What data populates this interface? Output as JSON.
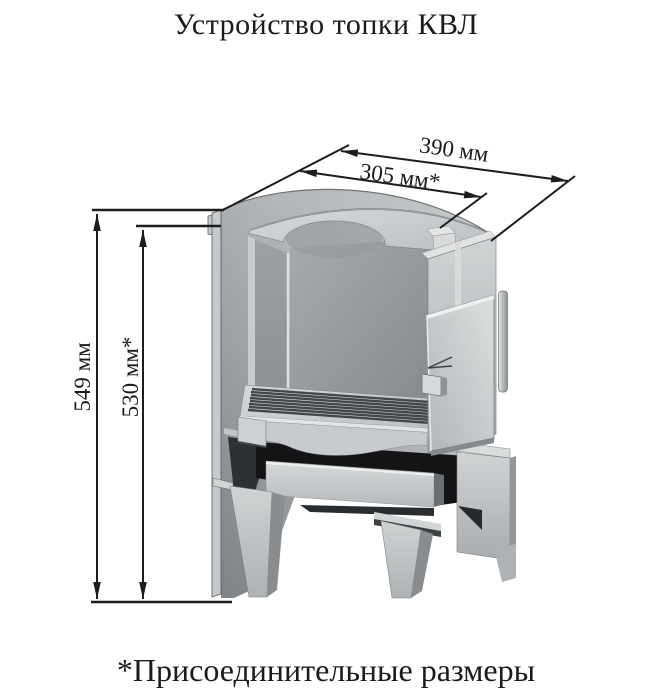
{
  "title": "Устройство топки КВЛ",
  "footnote": "*Присоединительные размеры",
  "dimensions": {
    "depth_outer": "390 мм",
    "depth_connection": "305 мм*",
    "height_outer": "549 мм",
    "height_connection": "530 мм*"
  },
  "figure": {
    "illustration": "kvl-firebox-cutaway-drawing",
    "colors": {
      "background": "#ffffff",
      "dimension_lines": "#1c1c1c",
      "metal_light": "#d4d7d8",
      "metal_mid": "#a6aaac",
      "metal_shadow": "#85898b",
      "cavity_dark": "#141416"
    }
  }
}
